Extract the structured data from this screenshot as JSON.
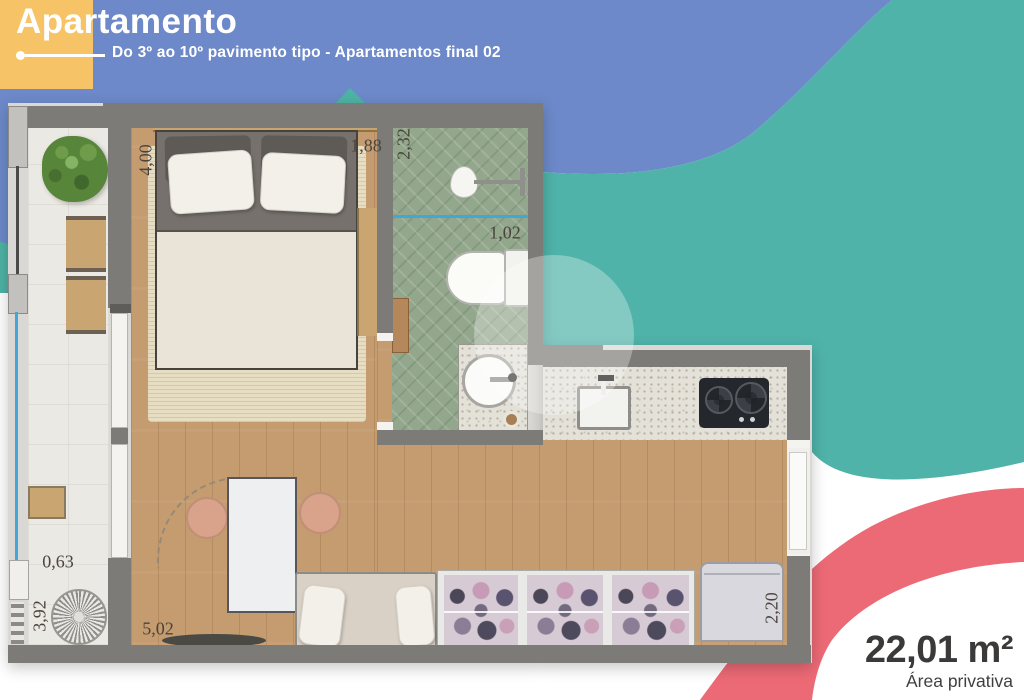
{
  "header": {
    "title": "Apartamento",
    "subtitle": "Do 3º ao 10º pavimento tipo - Apartamentos final 02"
  },
  "area_badge": {
    "value": "22,01 m²",
    "label": "Área privativa"
  },
  "dimensions": {
    "bedroom_length": "4,00",
    "bed_width": "1,88",
    "bathroom_length": "2,32",
    "bathroom_width": "1,02",
    "balcony_width": "0,63",
    "balcony_length": "3,92",
    "living_length": "5,02",
    "entry_width": "2,20"
  },
  "colors": {
    "blue_blob": "#6d89c9",
    "teal_blob": "#4fb3a9",
    "yellow_accent": "#f6c467",
    "coral_arc": "#ec6a76",
    "wall_gray": "#7d7b78",
    "wood_floor": "#c59b70",
    "bath_tile": "#93a78c",
    "glass_blue": "#3fa8d8",
    "text_dark": "#3b3a39"
  }
}
